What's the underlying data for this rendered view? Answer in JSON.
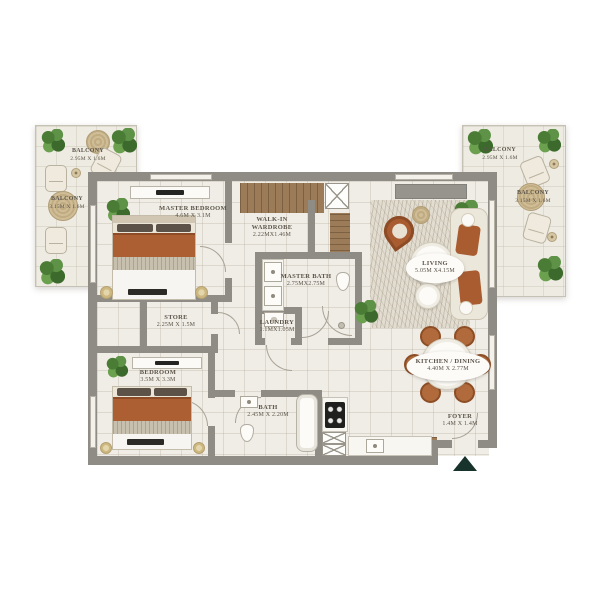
{
  "rooms": [
    {
      "id": "master-bedroom",
      "name": "MASTER BEDROOM",
      "dims": "4.6M X 3.1M"
    },
    {
      "id": "walk-in-wardrobe",
      "name": "WALK-IN WARDROBE",
      "dims": "2.22MX1.46M"
    },
    {
      "id": "master-bath",
      "name": "MASTER BATH",
      "dims": "2.75MX2.75M"
    },
    {
      "id": "store",
      "name": "STORE",
      "dims": "2.25M X 1.5M"
    },
    {
      "id": "laundry",
      "name": "LAUNDRY",
      "dims": "1.1MX1.05M"
    },
    {
      "id": "bedroom",
      "name": "BEDROOM",
      "dims": "3.5M X 3.3M"
    },
    {
      "id": "bath",
      "name": "BATH",
      "dims": "2.45M X 2.20M"
    },
    {
      "id": "living",
      "name": "LIVING",
      "dims": "5.05M X4.15M"
    },
    {
      "id": "kitchen-dining",
      "name": "KITCHEN / DINING",
      "dims": "4.40M X 2.77M"
    },
    {
      "id": "foyer",
      "name": "FOYER",
      "dims": "1.4M X 1.4M"
    }
  ],
  "balconies": [
    {
      "position": "left-top",
      "name": "BALCONY",
      "dims": "2.95M X 1.6M"
    },
    {
      "position": "left-bottom",
      "name": "BALCONY",
      "dims": "3.15M X 1.6M"
    },
    {
      "position": "right-top",
      "name": "BALCONY",
      "dims": "2.95M X 1.6M"
    },
    {
      "position": "right-bottom",
      "name": "BALCONY",
      "dims": "3.15M X 1.6M"
    }
  ],
  "colors": {
    "wall": "#8f8c86",
    "floor": "#f0ede6",
    "wood": "#9c7b58",
    "rust_accent": "#ab5f33",
    "plant_green": "#4a7c36",
    "tan": "#c9b68e",
    "label_text": "#5b544a",
    "entrance_arrow": "#17332c"
  }
}
